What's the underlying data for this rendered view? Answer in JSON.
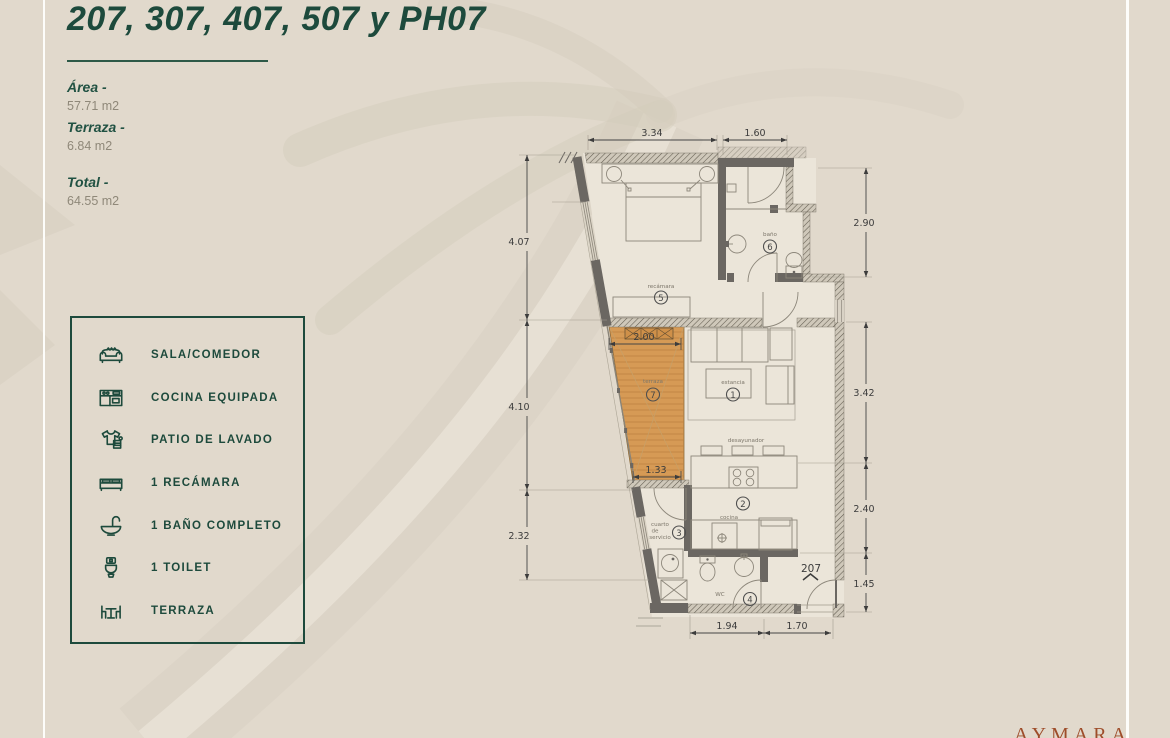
{
  "header": {
    "title": "207, 307, 407, 507 y PH07"
  },
  "areas": {
    "area_label": "Área -",
    "area_value": "57.71 m2",
    "terraza_label": "Terraza -",
    "terraza_value": "6.84 m2",
    "total_label": "Total -",
    "total_value": "64.55 m2"
  },
  "legend": {
    "items": [
      {
        "icon": "sofa-icon",
        "label": "SALA/COMEDOR"
      },
      {
        "icon": "kitchen-icon",
        "label": "COCINA EQUIPADA"
      },
      {
        "icon": "laundry-icon",
        "label": "PATIO DE LAVADO"
      },
      {
        "icon": "bed-icon",
        "label": "1 RECÁMARA"
      },
      {
        "icon": "bath-sink-icon",
        "label": "1 BAÑO COMPLETO"
      },
      {
        "icon": "toilet-icon",
        "label": "1 TOILET"
      },
      {
        "icon": "terrace-icon",
        "label": "TERRAZA"
      }
    ]
  },
  "floorplan": {
    "unit_number": "207",
    "rooms": {
      "estancia": {
        "label": "estancia",
        "num": "1"
      },
      "cocina": {
        "label": "cocina",
        "num": "2"
      },
      "cuarto": {
        "line1": "cuarto",
        "line2": "de",
        "line3": "servicio",
        "num": "3"
      },
      "wc": {
        "label": "WC",
        "num": "4"
      },
      "recamara": {
        "label": "recámara",
        "num": "5"
      },
      "bano": {
        "label": "baño",
        "num": "6"
      },
      "terraza": {
        "label": "terraza",
        "num": "7"
      },
      "desayunador": {
        "label": "desayunador"
      }
    },
    "dims": {
      "top_recamara": "3.34",
      "top_bano": "1.60",
      "left_recamara": "4.07",
      "left_terraza": "4.10",
      "left_servicio": "2.32",
      "right_bano": "2.90",
      "right_estancia": "3.42",
      "right_cocina": "2.40",
      "right_entrada": "1.45",
      "bottom_wc": "1.94",
      "bottom_entrada": "1.70",
      "terraza_top": "2.00",
      "terraza_bottom": "1.33"
    }
  },
  "brand": {
    "name": "AYMARA"
  },
  "colors": {
    "green": "#1d4a3c",
    "rust": "#9e4d2a",
    "wood": "#d69a55",
    "background": "#e1d9cc"
  }
}
